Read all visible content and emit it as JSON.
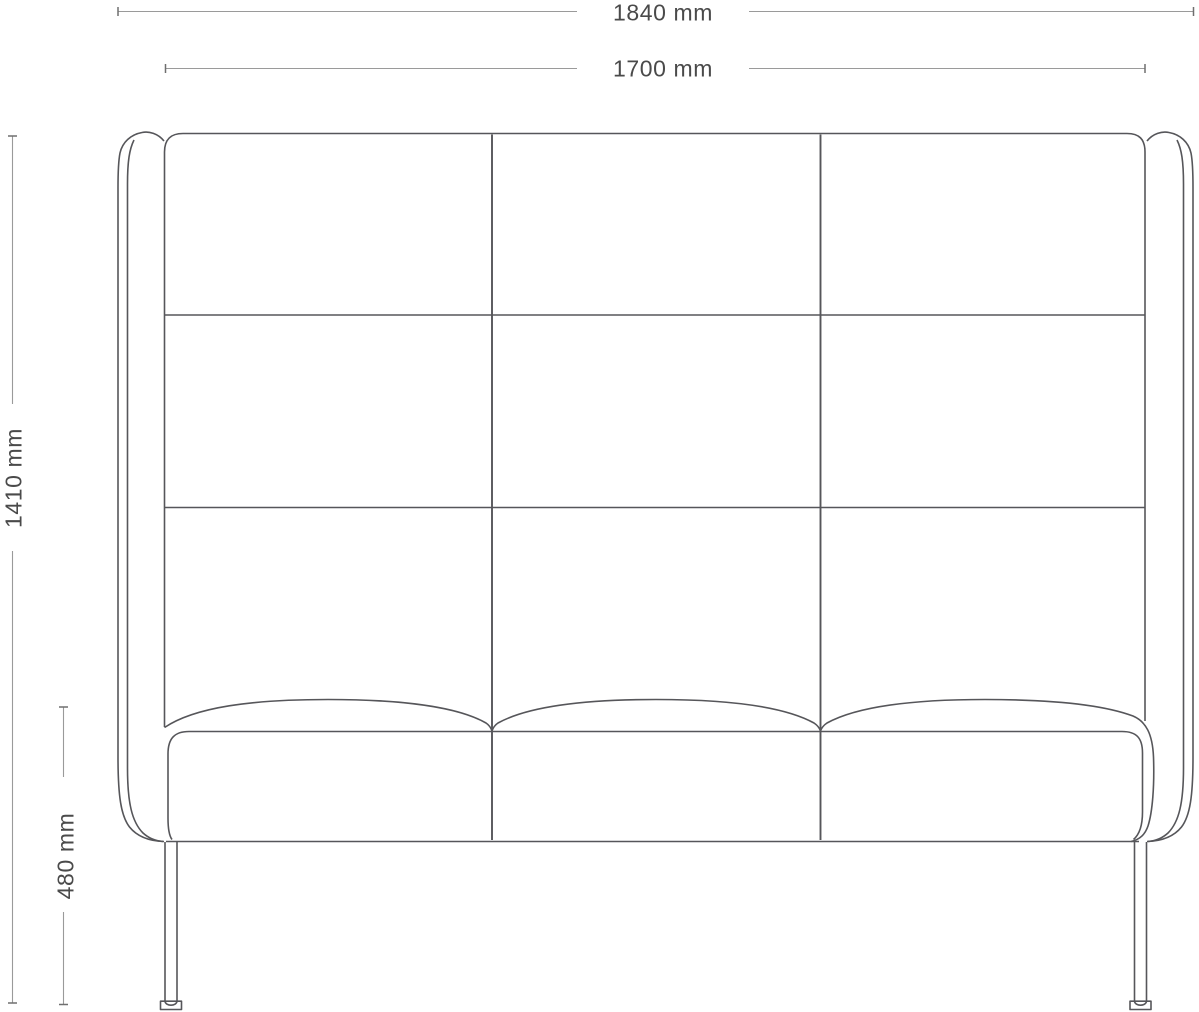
{
  "colors": {
    "background": "#ffffff",
    "drawing_line": "#56565a",
    "dimension_line": "#9a9a9a",
    "tick_line": "#6f6f6f",
    "label_text": "#4a4a4a"
  },
  "dimensions": {
    "overall_width": {
      "label": "1840 mm",
      "value": 1840,
      "unit": "mm"
    },
    "seat_width": {
      "label": "1700 mm",
      "value": 1700,
      "unit": "mm"
    },
    "overall_height": {
      "label": "1410 mm",
      "value": 1410,
      "unit": "mm"
    },
    "seat_height": {
      "label": "480 mm",
      "value": 480,
      "unit": "mm"
    }
  }
}
